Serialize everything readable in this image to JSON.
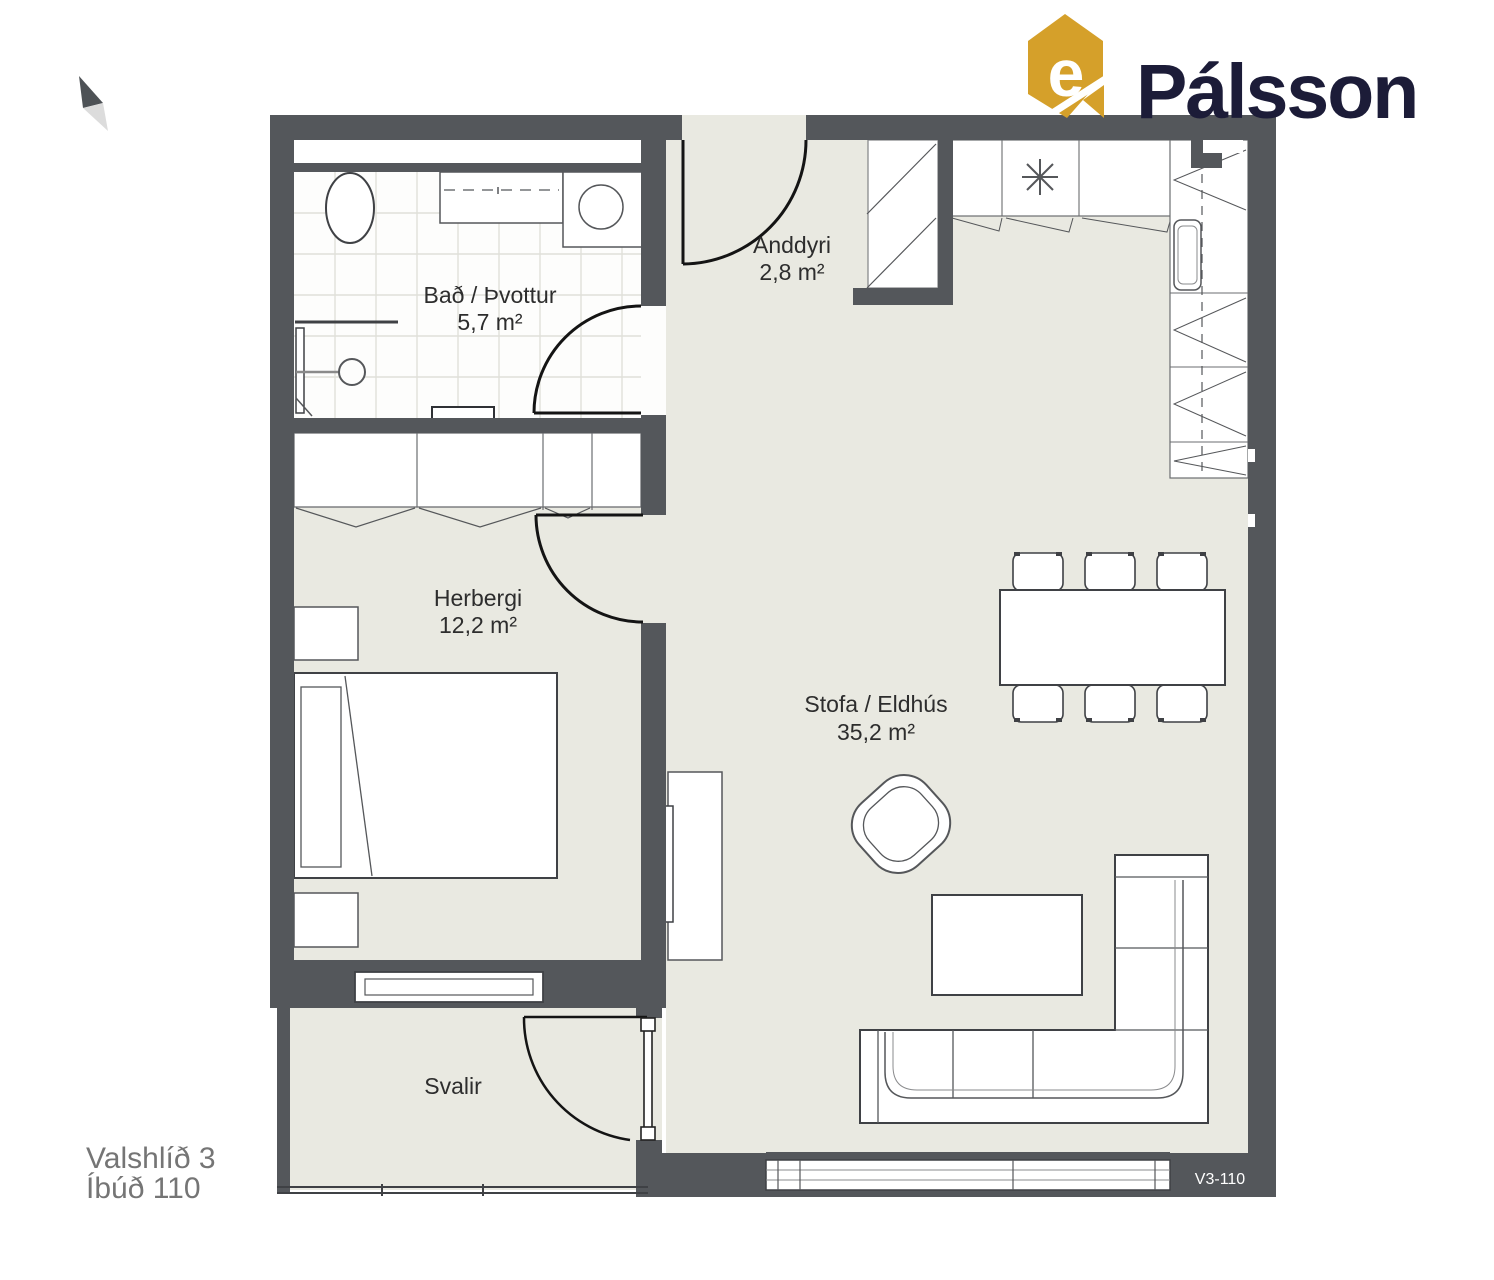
{
  "branding": {
    "logo_text": "Pálsson",
    "logo_letter": "e",
    "logo_icon": "palsson-house-icon",
    "logo_gold": "#d5a02a",
    "logo_navy": "#1c1c38"
  },
  "compass": {
    "icon": "north-arrow"
  },
  "plan": {
    "address_line1": "Valshlíð 3",
    "address_line2": "Íbúð 110",
    "unit_code": "V3-110",
    "rooms": [
      {
        "id": "bathroom",
        "name": "Bað / Þvottur",
        "area": "5,7 m²"
      },
      {
        "id": "entry",
        "name": "Anddyri",
        "area": "2,8 m²"
      },
      {
        "id": "bedroom",
        "name": "Herbergi",
        "area": "12,2 m²"
      },
      {
        "id": "living_kitchen",
        "name": "Stofa / Eldhús",
        "area": "35,2 m²"
      },
      {
        "id": "balcony",
        "name": "Svalir",
        "area": ""
      }
    ],
    "fixtures": [
      "toilet",
      "vanity",
      "washing-machine",
      "shower",
      "wardrobe",
      "closet",
      "bed",
      "nightstand",
      "cooktop",
      "kitchen-sink",
      "dining-table",
      "chair",
      "armchair",
      "coffee-table",
      "sofa",
      "tv-bench",
      "balcony-railing"
    ],
    "colors": {
      "wall": "#54575b",
      "floor": "#e9e9e1",
      "bath_floor": "#fdfdfc",
      "line": "#3f4145",
      "door": "#141414",
      "text": "#2d2d2d",
      "address_text": "#757575"
    }
  }
}
